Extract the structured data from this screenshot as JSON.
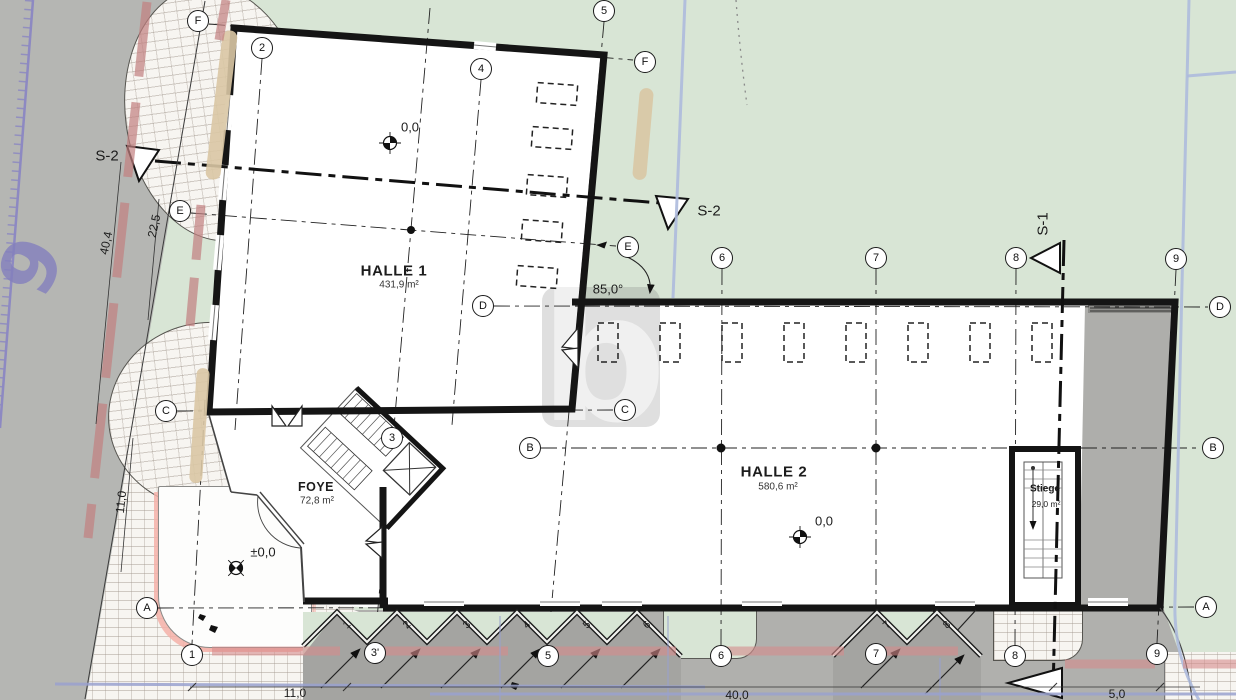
{
  "watermark": {
    "letter": "b"
  },
  "site": {
    "street_number": "6"
  },
  "grid": {
    "bubbles": [
      {
        "name": "grid-bubble-F-left",
        "label": "F",
        "x": 198,
        "y": 21
      },
      {
        "name": "grid-bubble-2-top",
        "label": "2",
        "x": 262,
        "y": 48
      },
      {
        "name": "grid-bubble-4-top",
        "label": "4",
        "x": 481,
        "y": 69
      },
      {
        "name": "grid-bubble-5-top",
        "label": "5",
        "x": 604,
        "y": 11
      },
      {
        "name": "grid-bubble-F-right",
        "label": "F",
        "x": 645,
        "y": 62
      },
      {
        "name": "grid-bubble-E-left",
        "label": "E",
        "x": 180,
        "y": 211
      },
      {
        "name": "grid-bubble-E-right",
        "label": "E",
        "x": 628,
        "y": 247
      },
      {
        "name": "grid-bubble-6-top",
        "label": "6",
        "x": 722,
        "y": 258
      },
      {
        "name": "grid-bubble-7-top",
        "label": "7",
        "x": 876,
        "y": 258
      },
      {
        "name": "grid-bubble-8-top",
        "label": "8",
        "x": 1016,
        "y": 258
      },
      {
        "name": "grid-bubble-9-top",
        "label": "9",
        "x": 1176,
        "y": 259
      },
      {
        "name": "grid-bubble-D-left",
        "label": "D",
        "x": 483,
        "y": 306
      },
      {
        "name": "grid-bubble-D-right",
        "label": "D",
        "x": 1220,
        "y": 307
      },
      {
        "name": "grid-bubble-C-left",
        "label": "C",
        "x": 166,
        "y": 411
      },
      {
        "name": "grid-bubble-C-right",
        "label": "C",
        "x": 625,
        "y": 410
      },
      {
        "name": "grid-bubble-3-mid",
        "label": "3",
        "x": 392,
        "y": 438
      },
      {
        "name": "grid-bubble-B-left",
        "label": "B",
        "x": 530,
        "y": 448
      },
      {
        "name": "grid-bubble-B-right",
        "label": "B",
        "x": 1213,
        "y": 448
      },
      {
        "name": "grid-bubble-A-left",
        "label": "A",
        "x": 147,
        "y": 608
      },
      {
        "name": "grid-bubble-A-right",
        "label": "A",
        "x": 1206,
        "y": 607
      },
      {
        "name": "grid-bubble-1-bottom",
        "label": "1",
        "x": 192,
        "y": 655
      },
      {
        "name": "grid-bubble-3p-bottom",
        "label": "3'",
        "x": 375,
        "y": 653
      },
      {
        "name": "grid-bubble-5-bottom",
        "label": "5",
        "x": 548,
        "y": 656
      },
      {
        "name": "grid-bubble-6-bottom",
        "label": "6",
        "x": 721,
        "y": 656
      },
      {
        "name": "grid-bubble-7-bottom",
        "label": "7",
        "x": 876,
        "y": 654
      },
      {
        "name": "grid-bubble-8-bottom",
        "label": "8",
        "x": 1015,
        "y": 656
      },
      {
        "name": "grid-bubble-9-bottom",
        "label": "9",
        "x": 1157,
        "y": 654
      }
    ]
  },
  "texts": [
    {
      "name": "room-halle1-name",
      "text": "HALLE 1",
      "x": 394,
      "y": 271,
      "rot": 0,
      "cls": "th"
    },
    {
      "name": "room-halle1-area",
      "text": "431,9 m²",
      "x": 399,
      "y": 285,
      "rot": 0,
      "cls": "ts"
    },
    {
      "name": "room-halle2-name",
      "text": "HALLE 2",
      "x": 774,
      "y": 472,
      "rot": 0,
      "cls": "th"
    },
    {
      "name": "room-halle2-area",
      "text": "580,6 m²",
      "x": 778,
      "y": 487,
      "rot": 0,
      "cls": "ts"
    },
    {
      "name": "room-foyer-name",
      "text": "FOYE",
      "x": 316,
      "y": 487,
      "rot": 0,
      "cls": "tf"
    },
    {
      "name": "room-foyer-area",
      "text": "72,8 m²",
      "x": 317,
      "y": 501,
      "rot": 0,
      "cls": "ts"
    },
    {
      "name": "room-stiege-name",
      "text": "Stiege",
      "x": 1045,
      "y": 489,
      "rot": 0,
      "cls": "tg"
    },
    {
      "name": "room-stiege-area",
      "text": "29,0 m²",
      "x": 1046,
      "y": 504,
      "rot": 0,
      "cls": "tgs"
    },
    {
      "name": "level-halle1",
      "text": "0,0",
      "x": 410,
      "y": 127,
      "rot": 0,
      "cls": "te"
    },
    {
      "name": "level-halle2",
      "text": "0,0",
      "x": 824,
      "y": 521,
      "rot": 0,
      "cls": "te"
    },
    {
      "name": "level-plaza",
      "text": "±0,0",
      "x": 263,
      "y": 552,
      "rot": 0,
      "cls": "te"
    },
    {
      "name": "angle-label",
      "text": "85,0°",
      "x": 608,
      "y": 289,
      "rot": 0,
      "cls": "ta"
    },
    {
      "name": "section-s2-left",
      "text": "S-2",
      "x": 107,
      "y": 156,
      "rot": 0,
      "cls": "tsec"
    },
    {
      "name": "section-s2-right",
      "text": "S-2",
      "x": 709,
      "y": 211,
      "rot": 0,
      "cls": "tsec"
    },
    {
      "name": "section-s1-top",
      "text": "S-1",
      "x": 1043,
      "y": 224,
      "rot": -90,
      "cls": "tsec"
    },
    {
      "name": "dim-40-4",
      "text": "40,4",
      "x": 106,
      "y": 243,
      "rot": -78,
      "cls": "tdim"
    },
    {
      "name": "dim-22-5",
      "text": "22,5",
      "x": 154,
      "y": 226,
      "rot": -78,
      "cls": "tdim"
    },
    {
      "name": "dim-11-0-left",
      "text": "11,0",
      "x": 121,
      "y": 502,
      "rot": -84,
      "cls": "tdim"
    },
    {
      "name": "dim-11-0-bottom",
      "text": "11,0",
      "x": 295,
      "y": 693,
      "rot": 0,
      "cls": "tdim"
    },
    {
      "name": "dim-40-0-bottom",
      "text": "40,0",
      "x": 737,
      "y": 695,
      "rot": 0,
      "cls": "tdim"
    },
    {
      "name": "dim-5-0-bottom",
      "text": "5,0",
      "x": 1117,
      "y": 694,
      "rot": 0,
      "cls": "tdim"
    },
    {
      "name": "parking-1",
      "text": "1",
      "x": 347,
      "y": 625,
      "rot": -45,
      "cls": "tp"
    },
    {
      "name": "parking-2",
      "text": "2",
      "x": 407,
      "y": 625,
      "rot": -45,
      "cls": "tp"
    },
    {
      "name": "parking-3",
      "text": "3",
      "x": 467,
      "y": 625,
      "rot": -45,
      "cls": "tp"
    },
    {
      "name": "parking-4",
      "text": "4",
      "x": 527,
      "y": 625,
      "rot": -45,
      "cls": "tp"
    },
    {
      "name": "parking-5",
      "text": "5",
      "x": 587,
      "y": 625,
      "rot": -45,
      "cls": "tp"
    },
    {
      "name": "parking-6",
      "text": "6",
      "x": 647,
      "y": 625,
      "rot": -45,
      "cls": "tp"
    },
    {
      "name": "parking-7",
      "text": "7",
      "x": 887,
      "y": 625,
      "rot": -45,
      "cls": "tp"
    },
    {
      "name": "parking-8",
      "text": "8",
      "x": 947,
      "y": 625,
      "rot": -45,
      "cls": "tp"
    }
  ]
}
